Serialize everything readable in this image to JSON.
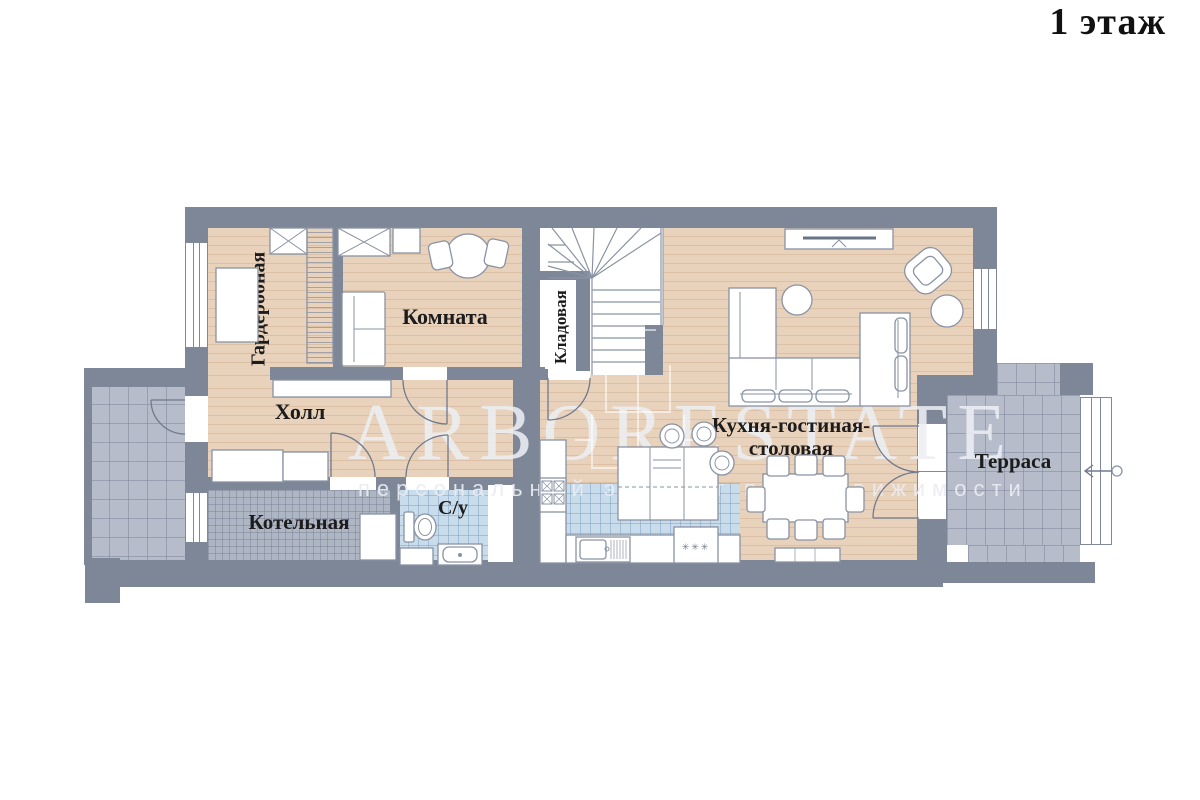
{
  "title": "1 этаж",
  "watermark": {
    "brand": "ARBORESTATE",
    "tagline": "персональный эксперт по недвижимости"
  },
  "rooms": {
    "garderobnaya": {
      "label": "Гардеробная"
    },
    "komnata": {
      "label": "Комната"
    },
    "kladovaya": {
      "label": "Кладовая"
    },
    "holl": {
      "label": "Холл"
    },
    "kotelnaya": {
      "label": "Котельная"
    },
    "su": {
      "label": "С/у"
    },
    "kuhnya": {
      "label_line1": "Кухня-гостиная-",
      "label_line2": "столовая"
    },
    "terrasa": {
      "label": "Терраса"
    }
  },
  "annotations": {
    "dishwasher_marks": "✳✳✳"
  },
  "colors": {
    "wall": "#7d8797",
    "wood_floor": "#e9d2bc",
    "tile_gray": "#b6bcc9",
    "tile_boiler": "#aeb5c3",
    "tile_blue": "#c8dcec",
    "outline": "#8a93a3",
    "label_text": "#1c1c1c"
  }
}
